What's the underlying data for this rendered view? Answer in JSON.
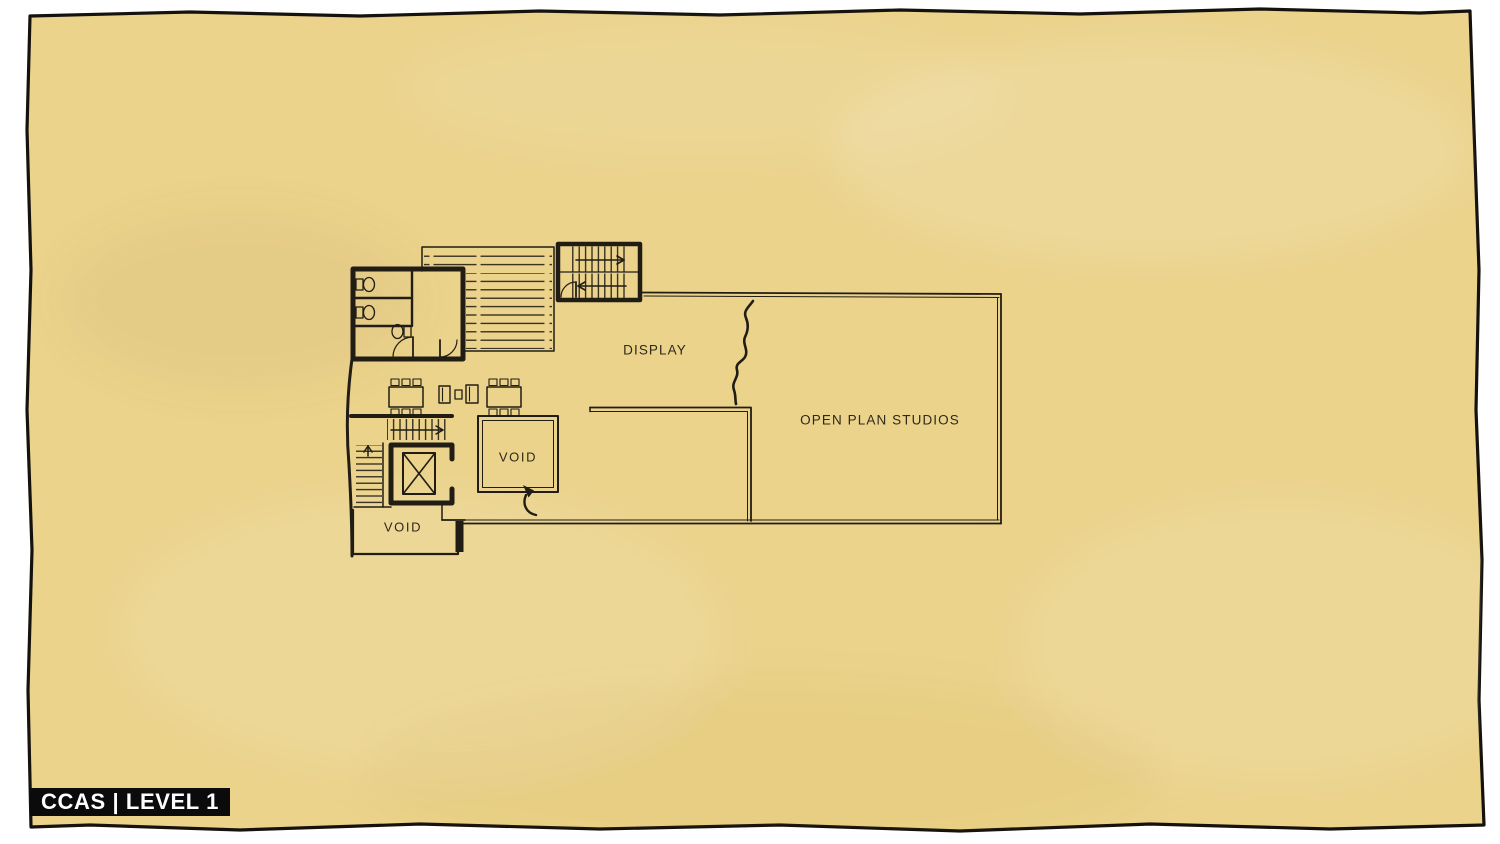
{
  "page": {
    "badge": "CCAS | LEVEL 1"
  },
  "plan": {
    "labels": {
      "display": "DISPLAY",
      "open_plan_studios": "OPEN PLAN STUDIOS",
      "void_center": "VOID",
      "void_lower_left": "VOID"
    },
    "features": [
      "restroom-block",
      "toilet-icons",
      "ramp-hatch-area",
      "stairwell-top",
      "stair-run-lower",
      "elevator-shaft",
      "work-tables-with-chairs",
      "lounge-chairs",
      "interior-partition-wall",
      "sketch-squiggle-mark",
      "void-arrow-mark"
    ]
  },
  "colors": {
    "page_bg": "#ffffff",
    "paper": "#ebd38c",
    "ink": "#211d15",
    "border_ink": "#15110c",
    "label_text": "#2e2819",
    "badge_bg": "#0b0b0b",
    "badge_text": "#ffffff"
  }
}
